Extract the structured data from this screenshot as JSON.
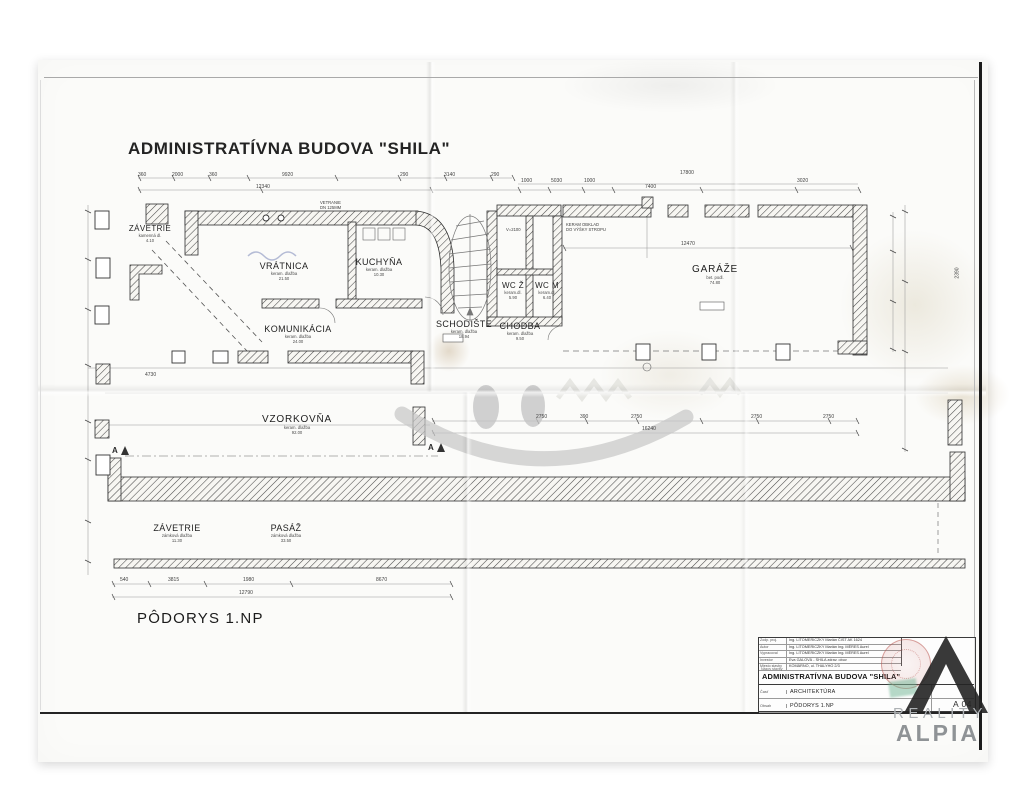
{
  "page": {
    "title": "ADMINISTRATÍVNA BUDOVA \"SHILA\"",
    "plan_label": "PÔDORYS 1.NP"
  },
  "rooms": [
    {
      "name": "ZÁVETRIE",
      "line1": "kamenná dl.",
      "line2": "4.10"
    },
    {
      "name": "VRÁTNICA",
      "line1": "keram. dlažba",
      "line2": "21.50"
    },
    {
      "name": "KUCHYŇA",
      "line1": "keram. dlažba",
      "line2": "10.30"
    },
    {
      "name": "KOMUNIKÁCIA",
      "line1": "keram. dlažba",
      "line2": "24.00"
    },
    {
      "name": "SCHODIŠTE",
      "line1": "keram. dlažba",
      "line2": "18.94"
    },
    {
      "name": "WC Ž",
      "line1": "keram.dl.",
      "line2": "5.90"
    },
    {
      "name": "WC M",
      "line1": "keram.dl.",
      "line2": "6.40"
    },
    {
      "name": "CHODBA",
      "line1": "keram. dlažba",
      "line2": "9.50"
    },
    {
      "name": "GARÁŽE",
      "line1": "bet. podl.",
      "line2": "74.80"
    },
    {
      "name": "VZORKOVŇA",
      "line1": "keram. dlažba",
      "line2": "92.00"
    },
    {
      "name": "ZÁVETRIE",
      "line1": "zámková dlažba",
      "line2": "11.30"
    },
    {
      "name": "PASÁŽ",
      "line1": "zámková dlažba",
      "line2": "33.50"
    }
  ],
  "annotations": {
    "vetranie1": "VETRANIE",
    "vetranie2": "DN 125MM",
    "obklad1": "KERAM OBKLAD",
    "obklad2": "DO VÝŠKY STROPU",
    "v2100": "V=2100",
    "marker_a": "A"
  },
  "dims": [
    "360",
    "2000",
    "360",
    "9920",
    "290",
    "3140",
    "290",
    "17800",
    "12340",
    "1000",
    "5030",
    "1000",
    "7400",
    "3020",
    "12470",
    "2750",
    "390",
    "2750",
    "2750",
    "2750",
    "16240",
    "540",
    "3815",
    "1980",
    "8670",
    "12790",
    "4730",
    "2390"
  ],
  "title_block": {
    "rows": [
      {
        "label": "Zodp. proj.",
        "value": "Ing. LITOMERICZKY Marián  ČIST AK 1624"
      },
      {
        "label": "Autor",
        "value": "Ing. LITOMERICZKY Marián  Ing. MÉRES Aurel"
      },
      {
        "label": "Vypracoval",
        "value": "Ing. LITOMERICZKY Marián  Ing. MÉRES Aurel"
      },
      {
        "label": "Investor",
        "value": "Eva GALOVÁ - SHILA zdrav. obuv"
      },
      {
        "label": "Miesto stavby",
        "value": "KOMÁRNO, ul. THALYHO 2/3"
      }
    ],
    "name_label": "Názov stavby",
    "project_title": "ADMINISTRATÍVNA BUDOVA \"SHILA\"",
    "part_label": "Časť",
    "part_value": "ARCHITEKTÚRA",
    "content_label": "Obsah",
    "content_value": "PÔDORYS 1.NP",
    "drawing_no": "A 04"
  },
  "watermark": {
    "line1": "REALITY",
    "line2": "ALPIA"
  }
}
